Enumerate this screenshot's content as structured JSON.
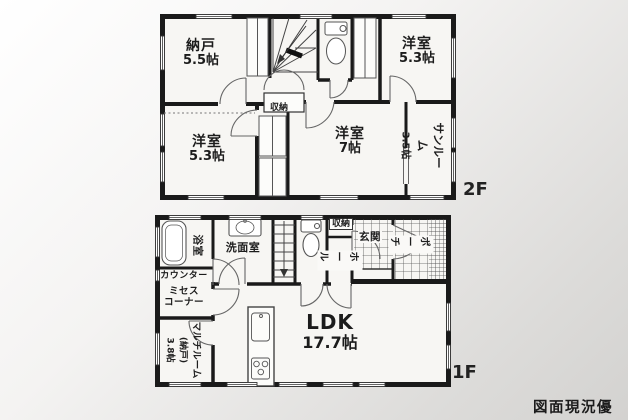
{
  "footer": {
    "note": "図面現況優先"
  },
  "floor2": {
    "label": "2F",
    "rooms": {
      "nando": {
        "name": "納戸",
        "size": "5.5帖"
      },
      "yoshitsu_tr": {
        "name": "洋室",
        "size": "5.3帖"
      },
      "yoshitsu_bl": {
        "name": "洋室",
        "size": "5.3帖"
      },
      "yoshitsu_c": {
        "name": "洋室",
        "size": "7帖"
      },
      "sunroom": {
        "name": "サンルーム",
        "size": "3.5帖"
      },
      "closet": {
        "name": "収納"
      }
    }
  },
  "floor1": {
    "label": "1F",
    "rooms": {
      "bath": {
        "name": "浴室"
      },
      "washroom": {
        "name": "洗面室"
      },
      "closet": {
        "name": "収納"
      },
      "hall": {
        "name": "ホール"
      },
      "entrance": {
        "name": "玄関"
      },
      "porch": {
        "name": "ポーチ"
      },
      "counter": {
        "name": "カウンター"
      },
      "mrs_corner": {
        "line1": "ミセス",
        "line2": "コーナー"
      },
      "multiroom": {
        "line1": "マルチルーム",
        "line2": "(納戸)",
        "line3": "3.8帖"
      },
      "ldk": {
        "name": "LDK",
        "size": "17.7帖"
      }
    }
  }
}
